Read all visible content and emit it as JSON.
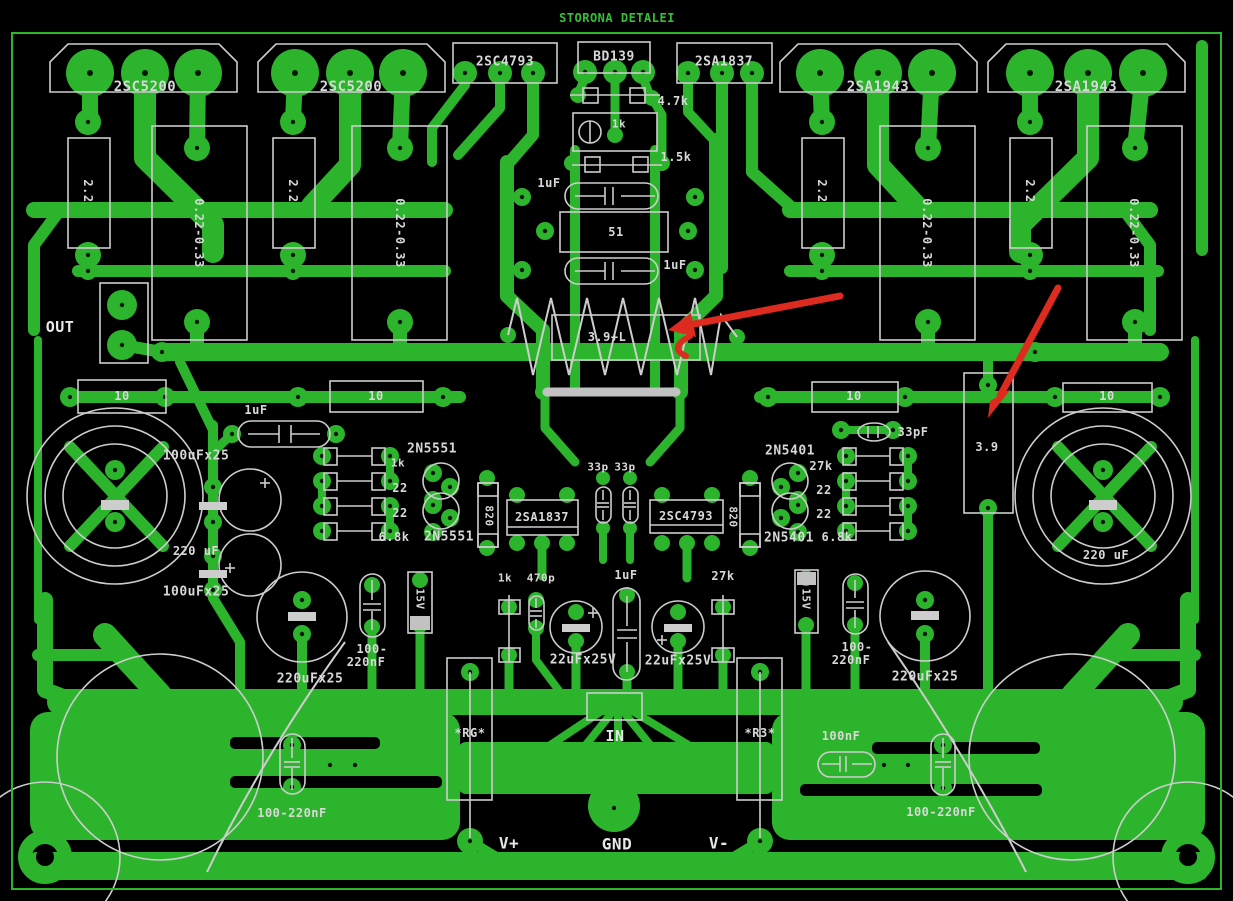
{
  "title": "STORONA DETALEI",
  "colors": {
    "background": "#000000",
    "copper": "#2db42d",
    "silkscreen": "#cdcdcd",
    "label": "#d8d8d8",
    "title_green": "#35c035",
    "annotation_arrow": "#dd2b20",
    "jumper_gray": "#c2c2c2"
  },
  "labels": [
    {
      "text": "STORONA DETALEI",
      "x": 617,
      "y": 18,
      "size": 12,
      "color": "#35c035",
      "ls": 3,
      "name": "board-title"
    },
    {
      "text": "2SC5200",
      "x": 145,
      "y": 87,
      "size": 14
    },
    {
      "text": "2SC5200",
      "x": 351,
      "y": 87,
      "size": 14
    },
    {
      "text": "2SC4793",
      "x": 505,
      "y": 62,
      "size": 13
    },
    {
      "text": "BD139",
      "x": 614,
      "y": 57,
      "size": 13
    },
    {
      "text": "2SA1837",
      "x": 724,
      "y": 62,
      "size": 13
    },
    {
      "text": "2SA1943",
      "x": 878,
      "y": 87,
      "size": 14
    },
    {
      "text": "2SA1943",
      "x": 1086,
      "y": 87,
      "size": 14
    },
    {
      "text": "4.7k",
      "x": 673,
      "y": 101,
      "size": 12
    },
    {
      "text": "1k",
      "x": 619,
      "y": 124,
      "size": 11
    },
    {
      "text": "1.5k",
      "x": 676,
      "y": 157,
      "size": 12
    },
    {
      "text": "1uF",
      "x": 549,
      "y": 183,
      "size": 12
    },
    {
      "text": "51",
      "x": 616,
      "y": 232,
      "size": 12
    },
    {
      "text": "1uF",
      "x": 675,
      "y": 265,
      "size": 12
    },
    {
      "text": "3.9+L",
      "x": 607,
      "y": 337,
      "size": 12
    },
    {
      "text": "2.2",
      "x": 88,
      "y": 191,
      "size": 12,
      "rot": 90
    },
    {
      "text": "0.22-0.33",
      "x": 199,
      "y": 233,
      "size": 12,
      "rot": 90
    },
    {
      "text": "2.2",
      "x": 293,
      "y": 191,
      "size": 12,
      "rot": 90
    },
    {
      "text": "0.22-0.33",
      "x": 400,
      "y": 233,
      "size": 12,
      "rot": 90
    },
    {
      "text": "2.2",
      "x": 822,
      "y": 191,
      "size": 12,
      "rot": 90
    },
    {
      "text": "0.22-0.33",
      "x": 927,
      "y": 233,
      "size": 12,
      "rot": 90
    },
    {
      "text": "2.2",
      "x": 1030,
      "y": 191,
      "size": 12,
      "rot": 90
    },
    {
      "text": "0.22-0.33",
      "x": 1134,
      "y": 233,
      "size": 12,
      "rot": 90
    },
    {
      "text": "OUT",
      "x": 60,
      "y": 327,
      "size": 15,
      "color": "#e8e8e8"
    },
    {
      "text": "10",
      "x": 122,
      "y": 396,
      "size": 12
    },
    {
      "text": "10",
      "x": 376,
      "y": 396,
      "size": 12
    },
    {
      "text": "10",
      "x": 854,
      "y": 396,
      "size": 12
    },
    {
      "text": "10",
      "x": 1107,
      "y": 396,
      "size": 12
    },
    {
      "text": "1uF",
      "x": 256,
      "y": 410,
      "size": 12
    },
    {
      "text": "33pF",
      "x": 913,
      "y": 432,
      "size": 12
    },
    {
      "text": "100uFx25",
      "x": 196,
      "y": 456,
      "size": 13
    },
    {
      "text": "100uFx25",
      "x": 196,
      "y": 592,
      "size": 13
    },
    {
      "text": "2N5551",
      "x": 432,
      "y": 449,
      "size": 13
    },
    {
      "text": "1k",
      "x": 398,
      "y": 463,
      "size": 11
    },
    {
      "text": "22",
      "x": 400,
      "y": 488,
      "size": 12
    },
    {
      "text": "22",
      "x": 400,
      "y": 513,
      "size": 12
    },
    {
      "text": "6.8k",
      "x": 394,
      "y": 537,
      "size": 12
    },
    {
      "text": "2N5551",
      "x": 449,
      "y": 537,
      "size": 13
    },
    {
      "text": "2N5401",
      "x": 790,
      "y": 451,
      "size": 13
    },
    {
      "text": "27k",
      "x": 821,
      "y": 466,
      "size": 12
    },
    {
      "text": "22",
      "x": 824,
      "y": 490,
      "size": 12
    },
    {
      "text": "22",
      "x": 824,
      "y": 514,
      "size": 12
    },
    {
      "text": "2N5401",
      "x": 789,
      "y": 538,
      "size": 13
    },
    {
      "text": "6.8k",
      "x": 837,
      "y": 537,
      "size": 12
    },
    {
      "text": "820",
      "x": 489,
      "y": 516,
      "size": 11,
      "rot": 90
    },
    {
      "text": "820",
      "x": 733,
      "y": 517,
      "size": 11,
      "rot": 90
    },
    {
      "text": "33p",
      "x": 598,
      "y": 467,
      "size": 11
    },
    {
      "text": "33p",
      "x": 625,
      "y": 467,
      "size": 11
    },
    {
      "text": "2SA1837",
      "x": 542,
      "y": 517,
      "size": 12
    },
    {
      "text": "2SC4793",
      "x": 686,
      "y": 516,
      "size": 12
    },
    {
      "text": "3.9",
      "x": 987,
      "y": 447,
      "size": 12
    },
    {
      "text": "220 uF",
      "x": 196,
      "y": 551,
      "size": 12
    },
    {
      "text": "220 uF",
      "x": 1106,
      "y": 555,
      "size": 12
    },
    {
      "text": "100-",
      "x": 372,
      "y": 649,
      "size": 12
    },
    {
      "text": "220nF",
      "x": 366,
      "y": 662,
      "size": 12
    },
    {
      "text": "100-",
      "x": 857,
      "y": 647,
      "size": 12
    },
    {
      "text": "220nF",
      "x": 851,
      "y": 660,
      "size": 12
    },
    {
      "text": "15V",
      "x": 420,
      "y": 599,
      "size": 11,
      "rot": 90
    },
    {
      "text": "15V",
      "x": 806,
      "y": 599,
      "size": 11,
      "rot": 90
    },
    {
      "text": "220uFx25",
      "x": 310,
      "y": 679,
      "size": 13
    },
    {
      "text": "220uFx25",
      "x": 925,
      "y": 677,
      "size": 13
    },
    {
      "text": "1k",
      "x": 505,
      "y": 578,
      "size": 11
    },
    {
      "text": "470p",
      "x": 541,
      "y": 578,
      "size": 11
    },
    {
      "text": "22uFx25V",
      "x": 583,
      "y": 660,
      "size": 13
    },
    {
      "text": "22uFx25V",
      "x": 678,
      "y": 661,
      "size": 13
    },
    {
      "text": "1uF",
      "x": 626,
      "y": 575,
      "size": 12
    },
    {
      "text": "27k",
      "x": 723,
      "y": 576,
      "size": 12
    },
    {
      "text": "IN",
      "x": 615,
      "y": 736,
      "size": 15,
      "color": "#e8e8e8"
    },
    {
      "text": "*RG*",
      "x": 470,
      "y": 733,
      "size": 12
    },
    {
      "text": "*R3*",
      "x": 760,
      "y": 733,
      "size": 12
    },
    {
      "text": "V+",
      "x": 509,
      "y": 843,
      "size": 16,
      "color": "#e8e8e8"
    },
    {
      "text": "GND",
      "x": 617,
      "y": 844,
      "size": 16,
      "color": "#e8e8e8"
    },
    {
      "text": "V-",
      "x": 719,
      "y": 843,
      "size": 16,
      "color": "#e8e8e8"
    },
    {
      "text": "100nF",
      "x": 841,
      "y": 736,
      "size": 12
    },
    {
      "text": "100-220nF",
      "x": 292,
      "y": 813,
      "size": 12
    },
    {
      "text": "100-220nF",
      "x": 941,
      "y": 812,
      "size": 12
    }
  ]
}
